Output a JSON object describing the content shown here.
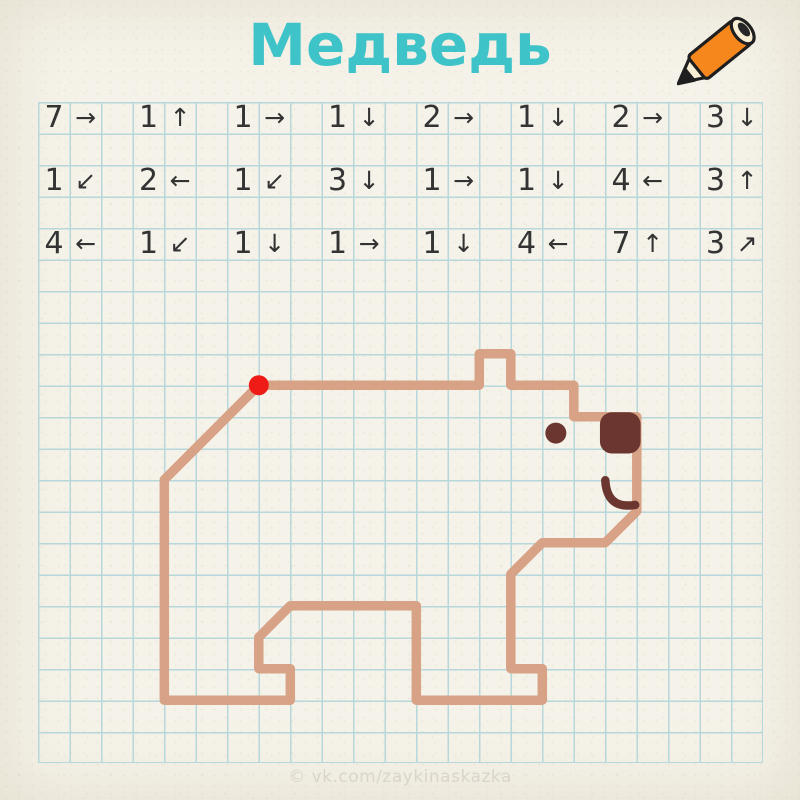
{
  "title": "Медведь",
  "watermark": "© vk.com/zaykinaskazka",
  "colors": {
    "paper": "#f5f2e9",
    "grid_line": "#b7d8da",
    "title": "#3ec3c9",
    "ink": "#333333",
    "bear_line": "#d8a287",
    "bear_dark": "#6b362f",
    "start_dot": "#ee1b17",
    "pencil_orange": "#f6871d",
    "pencil_cream": "#f8eed3",
    "outline": "#1f1f1f",
    "watermark": "#d9d5cb"
  },
  "grid": {
    "left": 38.3,
    "top": 101.7,
    "cell": 31.5,
    "cols": 23,
    "rows": 21
  },
  "instructions": {
    "arrow_glyphs": {
      "right": "→",
      "left": "←",
      "up": "↑",
      "down": "↓",
      "down-left": "↙",
      "up-right": "↗"
    },
    "rows": [
      [
        {
          "n": "7",
          "d": "right"
        },
        {
          "n": "1",
          "d": "up"
        },
        {
          "n": "1",
          "d": "right"
        },
        {
          "n": "1",
          "d": "down"
        },
        {
          "n": "2",
          "d": "right"
        },
        {
          "n": "1",
          "d": "down"
        },
        {
          "n": "2",
          "d": "right"
        },
        {
          "n": "3",
          "d": "down"
        }
      ],
      [
        {
          "n": "1",
          "d": "down-left"
        },
        {
          "n": "2",
          "d": "left"
        },
        {
          "n": "1",
          "d": "down-left"
        },
        {
          "n": "3",
          "d": "down"
        },
        {
          "n": "1",
          "d": "right"
        },
        {
          "n": "1",
          "d": "down"
        },
        {
          "n": "4",
          "d": "left"
        },
        {
          "n": "3",
          "d": "up"
        }
      ],
      [
        {
          "n": "4",
          "d": "left"
        },
        {
          "n": "1",
          "d": "down-left"
        },
        {
          "n": "1",
          "d": "down"
        },
        {
          "n": "1",
          "d": "right"
        },
        {
          "n": "1",
          "d": "down"
        },
        {
          "n": "4",
          "d": "left"
        },
        {
          "n": "7",
          "d": "up"
        },
        {
          "n": "3",
          "d": "up-right"
        }
      ]
    ]
  },
  "drawing": {
    "start_cell": {
      "col": 7,
      "row": 9
    },
    "start_dot_radius_px": 10,
    "outline_stroke_px": 9.5,
    "eye": {
      "col": 16.43,
      "row": 10.52,
      "r_px": 10.5
    },
    "nose": {
      "col": 17.83,
      "row": 9.86,
      "w_cells": 1.29,
      "h_cells": 1.31,
      "corner_px": 12
    },
    "mouth": {
      "start": [
        18.0,
        12.02
      ],
      "ctrl": [
        18.05,
        12.95
      ],
      "end": [
        18.95,
        12.8
      ],
      "stroke_px": 8.5
    }
  }
}
